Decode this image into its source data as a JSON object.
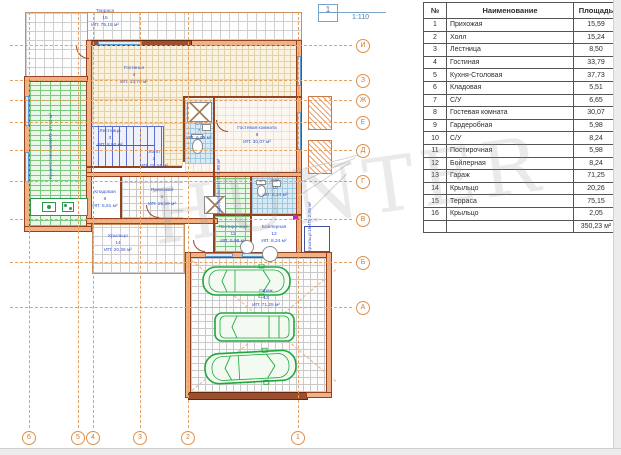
{
  "title_mark": {
    "number": "1",
    "scale": "1:110"
  },
  "watermark_text": "HUNTER",
  "axes": {
    "bottom": [
      "6",
      "5",
      "4",
      "3",
      "2",
      "1"
    ],
    "right": [
      "И",
      "З",
      "Ж",
      "Е",
      "Д",
      "Г",
      "В",
      "Б",
      "А"
    ]
  },
  "rooms": [
    {
      "id": "terrace",
      "name": "Терраса",
      "number": "15",
      "area": "ИП: 75,15 м²"
    },
    {
      "id": "living",
      "name": "Гостиная",
      "number": "4",
      "area": "ИП: 33,79 м²"
    },
    {
      "id": "kitchen",
      "name": "Кухня-Столовая",
      "number": "5",
      "area": "ИП: 37,73 м²"
    },
    {
      "id": "stairs",
      "name": "Лестница",
      "number": "3",
      "area": "ИП: 8,50 м²"
    },
    {
      "id": "hall",
      "name": "Холл",
      "number": "2",
      "area": "ИП: 15,24 м²"
    },
    {
      "id": "storage",
      "name": "Кладовая",
      "number": "6",
      "area": "ИП: 5,51 м²"
    },
    {
      "id": "entry",
      "name": "Прихожая",
      "number": "1",
      "area": "ИП: 15,59 м²"
    },
    {
      "id": "wc7",
      "name": "С/У",
      "number": "7",
      "area": "ИП: 6,65 м²"
    },
    {
      "id": "guest",
      "name": "Гостевая комната",
      "number": "8",
      "area": "ИП: 30,07 м²"
    },
    {
      "id": "wardrobe",
      "name": "Гардеробная",
      "number": "9",
      "area": "ИП: 5,98 м²"
    },
    {
      "id": "wc10",
      "name": "С/У",
      "number": "10",
      "area": "ИП: 8,24 м²"
    },
    {
      "id": "laundry",
      "name": "Постирочная",
      "number": "11",
      "area": "ИП: 5,98 м²"
    },
    {
      "id": "boiler",
      "name": "Бойлерная",
      "number": "12",
      "area": "ИП: 8,24 м²"
    },
    {
      "id": "garage",
      "name": "Гараж",
      "number": "13",
      "area": "ИП: 71,25 м²"
    },
    {
      "id": "porch14",
      "name": "Крыльцо",
      "number": "14",
      "area": "ИП: 20,26 м²"
    },
    {
      "id": "porch16",
      "name": "Крыльцо",
      "number": "16",
      "area": "ИП: 2,05 м²"
    }
  ],
  "table": {
    "headers": [
      "№",
      "Наименование",
      "Площадь"
    ],
    "rows": [
      [
        "1",
        "Прихожая",
        "15,59"
      ],
      [
        "2",
        "Холл",
        "15,24"
      ],
      [
        "3",
        "Лестница",
        "8,50"
      ],
      [
        "4",
        "Гостиная",
        "33,79"
      ],
      [
        "5",
        "Кухня-Столовая",
        "37,73"
      ],
      [
        "6",
        "Кладовая",
        "5,51"
      ],
      [
        "7",
        "С/У",
        "6,65"
      ],
      [
        "8",
        "Гостевая комната",
        "30,07"
      ],
      [
        "9",
        "Гардеробная",
        "5,98"
      ],
      [
        "10",
        "С/У",
        "8,24"
      ],
      [
        "11",
        "Постирочная",
        "5,98"
      ],
      [
        "12",
        "Бойлерная",
        "8,24"
      ],
      [
        "13",
        "Гараж",
        "71,25"
      ],
      [
        "14",
        "Крыльцо",
        "20,26"
      ],
      [
        "15",
        "Терраса",
        "75,15"
      ],
      [
        "16",
        "Крыльцо",
        "2,05"
      ]
    ],
    "total": "350,23 м²"
  },
  "colors": {
    "wall_fill": "#f2b184",
    "wall_edge": "#94421f",
    "axis_orange": "#e0904a",
    "label_blue": "#3a55c8",
    "car_green": "#1fa83c",
    "tile_blue": "#d8eaf4",
    "hatch_green": "#7cc87c"
  }
}
